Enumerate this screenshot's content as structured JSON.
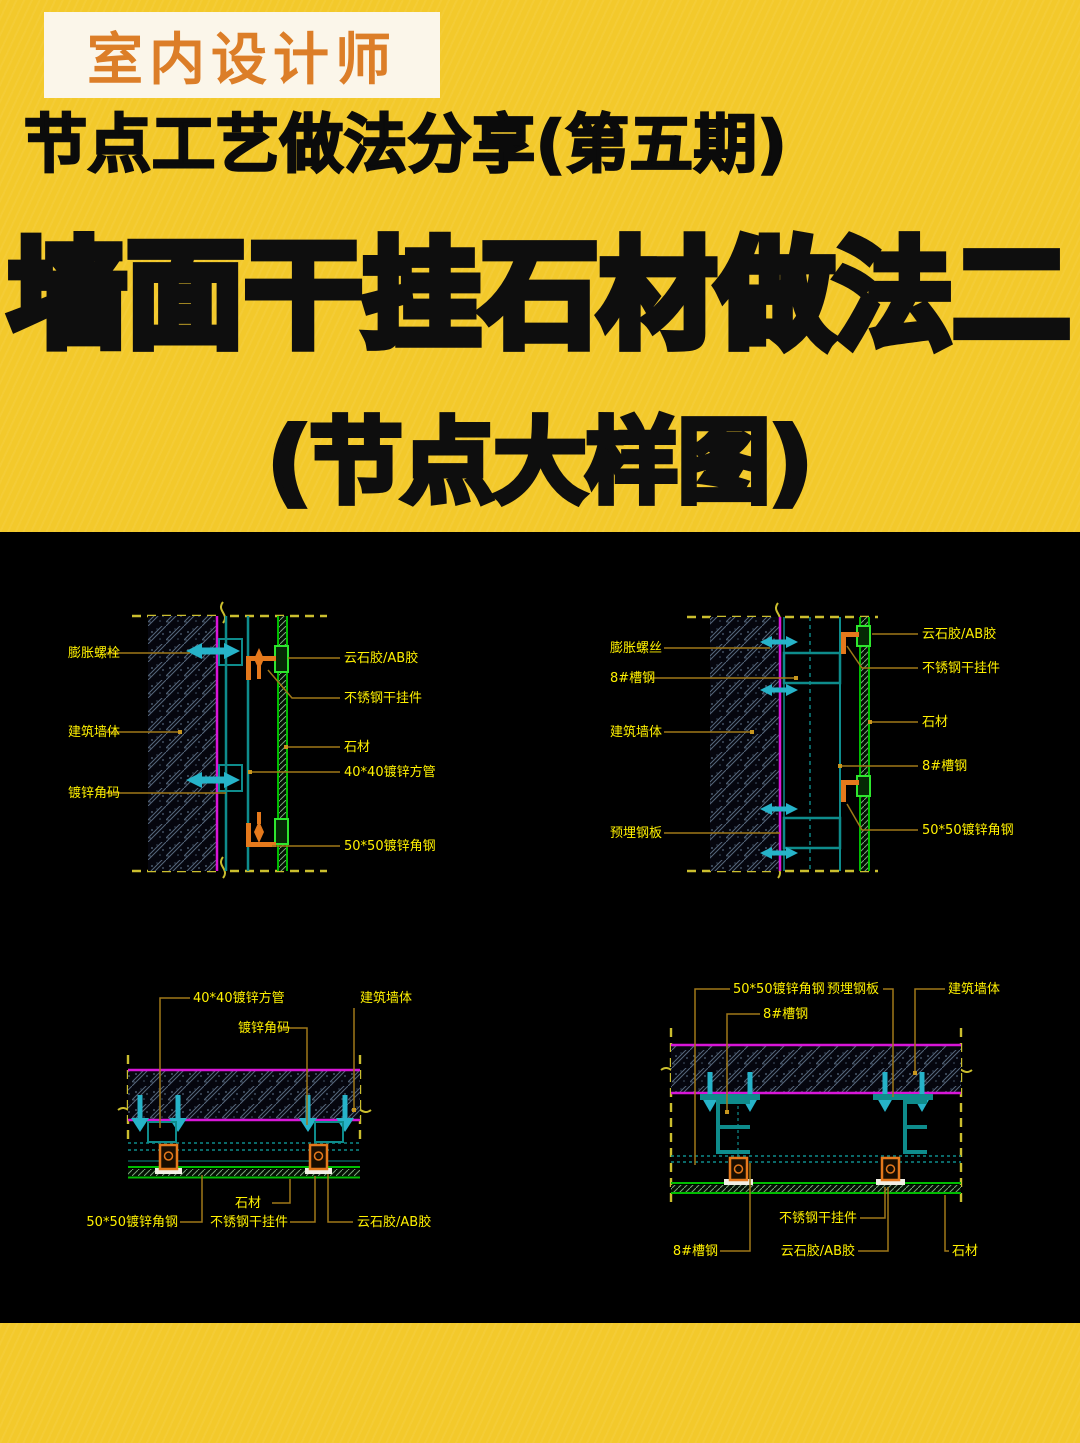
{
  "header": {
    "badge": "室内设计师",
    "series": "节点工艺做法分享(第五期)",
    "title": "墙面干挂石材做法二",
    "subtitle": "(节点大样图)"
  },
  "colors": {
    "background": "#F3C92B",
    "panel": "#000000",
    "badge_bg": "#FBF6EA",
    "badge_text": "#DC7E28",
    "title_text": "#0E0E0E",
    "cad_label": "#FFF100",
    "leader": "#A07818",
    "wall_face": "#D816D8",
    "steel": "#0E8C8C",
    "bolt": "#26B3C9",
    "stone": "#00BE00",
    "hanger": "#E5791C",
    "boundary_dash": "#CBBE2E"
  },
  "drawings": {
    "top_left": {
      "name": "墙面竖剖节点(方管体系)",
      "left_labels": [
        "膨胀螺栓",
        "建筑墙体",
        "镀锌角码"
      ],
      "right_labels": [
        "云石胶/AB胶",
        "不锈钢干挂件",
        "石材",
        "40*40镀锌方管",
        "50*50镀锌角钢"
      ]
    },
    "top_right": {
      "name": "墙面竖剖节点(槽钢体系)",
      "left_labels": [
        "膨胀螺丝",
        "8#槽钢",
        "建筑墙体",
        "预埋钢板"
      ],
      "right_labels": [
        "云石胶/AB胶",
        "不锈钢干挂件",
        "石材",
        "8#槽钢",
        "50*50镀锌角钢"
      ]
    },
    "bottom_left": {
      "name": "墙面横剖节点(方管体系)",
      "top_labels": [
        "40*40镀锌方管",
        "建筑墙体",
        "镀锌角码"
      ],
      "bottom_labels": [
        "石材",
        "50*50镀锌角钢",
        "不锈钢干挂件",
        "云石胶/AB胶"
      ]
    },
    "bottom_right": {
      "name": "墙面横剖节点(槽钢体系)",
      "top_labels": [
        "50*50镀锌角钢",
        "预埋钢板",
        "建筑墙体",
        "8#槽钢"
      ],
      "bottom_labels": [
        "不锈钢干挂件",
        "8#槽钢",
        "云石胶/AB胶",
        "石材"
      ]
    }
  }
}
